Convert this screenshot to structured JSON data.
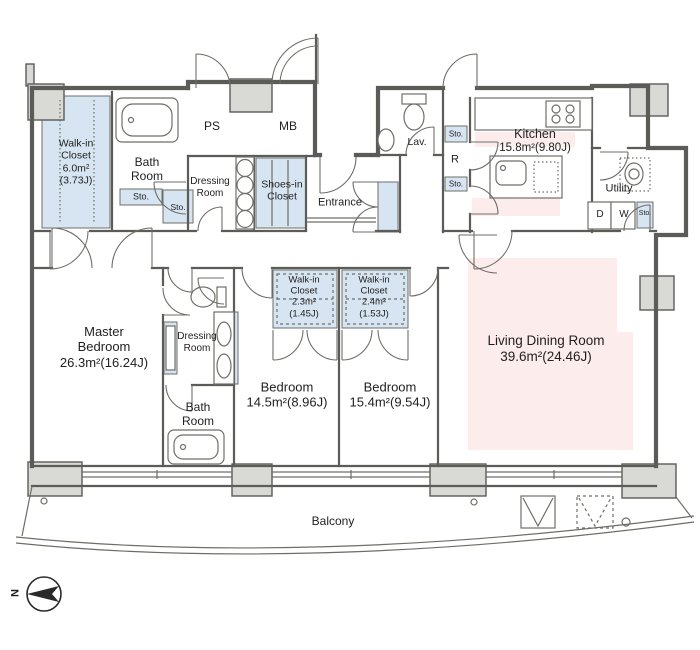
{
  "colors": {
    "wall": "#5b5b57",
    "column": "#d9d9d5",
    "line": "#6e6e68",
    "blue": "#d7e5f2",
    "pink": "#fdecec",
    "text": "#1f1f1f"
  },
  "rooms": {
    "walkin_closet_6": {
      "l1": "Walk-in",
      "l2": "Closet",
      "l3": "6.0m²",
      "l4": "(3.73J)"
    },
    "bath_top": {
      "l1": "Bath",
      "l2": "Room"
    },
    "ps": {
      "label": "PS"
    },
    "mb": {
      "label": "MB"
    },
    "dressing_top": {
      "l1": "Dressing",
      "l2": "Room"
    },
    "shoes_closet": {
      "l1": "Shoes-in",
      "l2": "Closet"
    },
    "entrance": {
      "label": "Entrance"
    },
    "lav": {
      "label": "Lav."
    },
    "refrigerator": {
      "label": "R"
    },
    "kitchen": {
      "l1": "Kitchen",
      "l2": "15.8m²(9.80J)"
    },
    "utility": {
      "label": "Utility"
    },
    "dryer": {
      "label": "D"
    },
    "washer": {
      "label": "W"
    },
    "master_bedroom": {
      "l1": "Master",
      "l2": "Bedroom",
      "l3": "26.3m²(16.24J)"
    },
    "dressing_mid": {
      "l1": "Dressing",
      "l2": "Room"
    },
    "bath_bottom": {
      "l1": "Bath",
      "l2": "Room"
    },
    "bedroom_1": {
      "l1": "Bedroom",
      "l2": "14.5m²(8.96J)"
    },
    "bedroom_2": {
      "l1": "Bedroom",
      "l2": "15.4m²(9.54J)"
    },
    "walkin_closet_23": {
      "l1": "Walk-in",
      "l2": "Closet",
      "l3": "2.3m²",
      "l4": "(1.45J)"
    },
    "walkin_closet_24": {
      "l1": "Walk-in",
      "l2": "Closet",
      "l3": "2.4m²",
      "l4": "(1.53J)"
    },
    "living_dining": {
      "l1": "Living Dining Room",
      "l2": "39.6m²(24.46J)"
    },
    "balcony": {
      "label": "Balcony"
    },
    "storage_label": "Sto."
  },
  "compass": {
    "north_label": "N"
  }
}
